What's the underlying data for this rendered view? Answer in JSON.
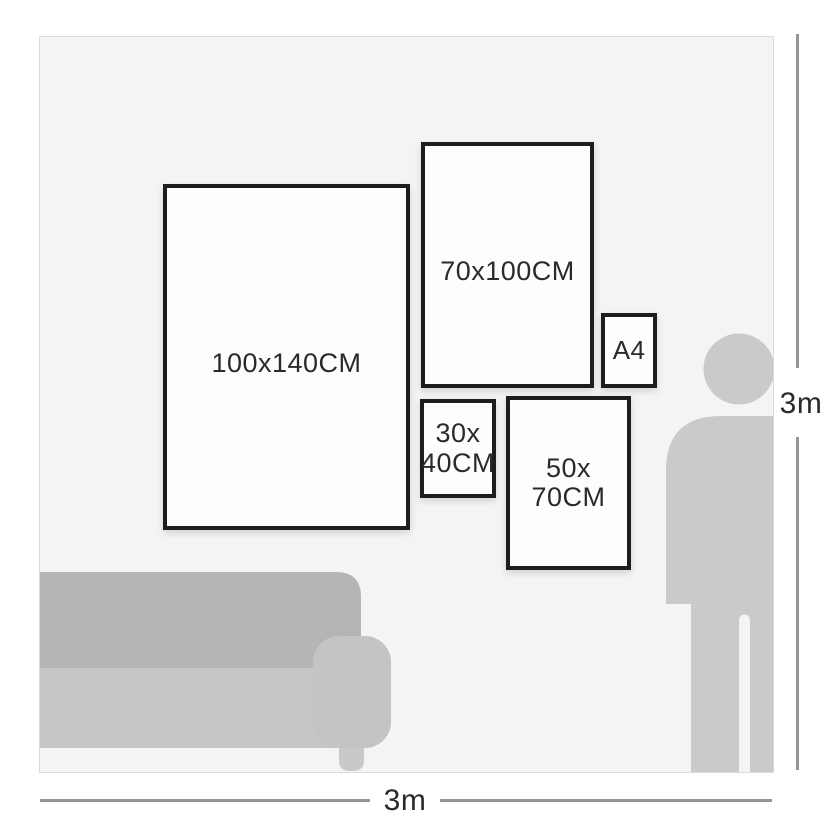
{
  "wall": {
    "frames": [
      {
        "name": "frame-100x140",
        "lines": [
          "100x140CM"
        ]
      },
      {
        "name": "frame-70x100",
        "lines": [
          "70x100CM"
        ]
      },
      {
        "name": "frame-a4",
        "lines": [
          "A4"
        ]
      },
      {
        "name": "frame-30x40",
        "lines": [
          "30x",
          "40CM"
        ]
      },
      {
        "name": "frame-50x70",
        "lines": [
          "50x",
          "70CM"
        ]
      }
    ],
    "furniture": {
      "sofa_icon": "sofa-silhouette",
      "person_icon": "person-silhouette"
    }
  },
  "dimensions": {
    "height_label": "3m",
    "width_label": "3m"
  },
  "colors": {
    "wall_bg": "#f4f4f5",
    "wall_border": "#d9dadc",
    "frame_border": "#1d1d1f",
    "frame_bg": "#fdfdfe",
    "person_silhouette": "#c9cacc",
    "sofa_backrest": "#b5b5b7",
    "sofa_seat": "#c6c6c8",
    "sofa_armrest": "#c4c4c6",
    "sofa_leg": "#c9c9cb",
    "dimension_line": "#939496",
    "text": "#2a2a2c"
  }
}
